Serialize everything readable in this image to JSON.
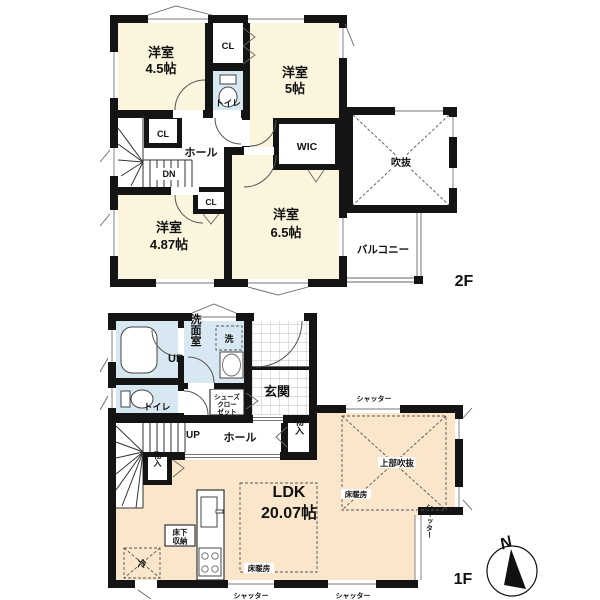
{
  "f2": {
    "floor_label": "2F",
    "room_45": {
      "name": "洋室",
      "size": "4.5帖"
    },
    "room_5": {
      "name": "洋室",
      "size": "5帖"
    },
    "room_487": {
      "name": "洋室",
      "size": "4.87帖"
    },
    "room_65": {
      "name": "洋室",
      "size": "6.5帖"
    },
    "cl_top": "CL",
    "cl_left": "CL",
    "cl_bottom": "CL",
    "toilet": "トイレ",
    "wic": "WIC",
    "hall": "ホール",
    "dn": "DN",
    "void": "吹抜",
    "balcony": "バルコニー"
  },
  "f1": {
    "floor_label": "1F",
    "ub": "UB",
    "senmenshitsu": "洗面室",
    "washer": "洗",
    "toilet": "トイレ",
    "shoes_closet": [
      "シューズ",
      "クロー",
      "ゼット"
    ],
    "genkan": "玄関",
    "up": "UP",
    "hall": "ホール",
    "closet_hall": "物入",
    "closet_stairs": "物入",
    "ldk": {
      "name": "LDK",
      "size": "20.07帖"
    },
    "floor_heating_ldk": "床暖房",
    "floor_heating_void": "床暖房",
    "upper_void": "上部吹抜",
    "underfloor_storage": [
      "床下",
      "収納"
    ],
    "fridge": "冷",
    "shutter_top": "シャッター",
    "shutter_right": "シャッター",
    "shutter_bottom_left": "シャッター",
    "shutter_bottom_right": "シャッター"
  },
  "compass_n": "N",
  "colors": {
    "room_cream": "#faf5dc",
    "ldk_peach": "#f9e6cb",
    "wet_blue": "#d8e8f2",
    "wall": "#141414"
  }
}
